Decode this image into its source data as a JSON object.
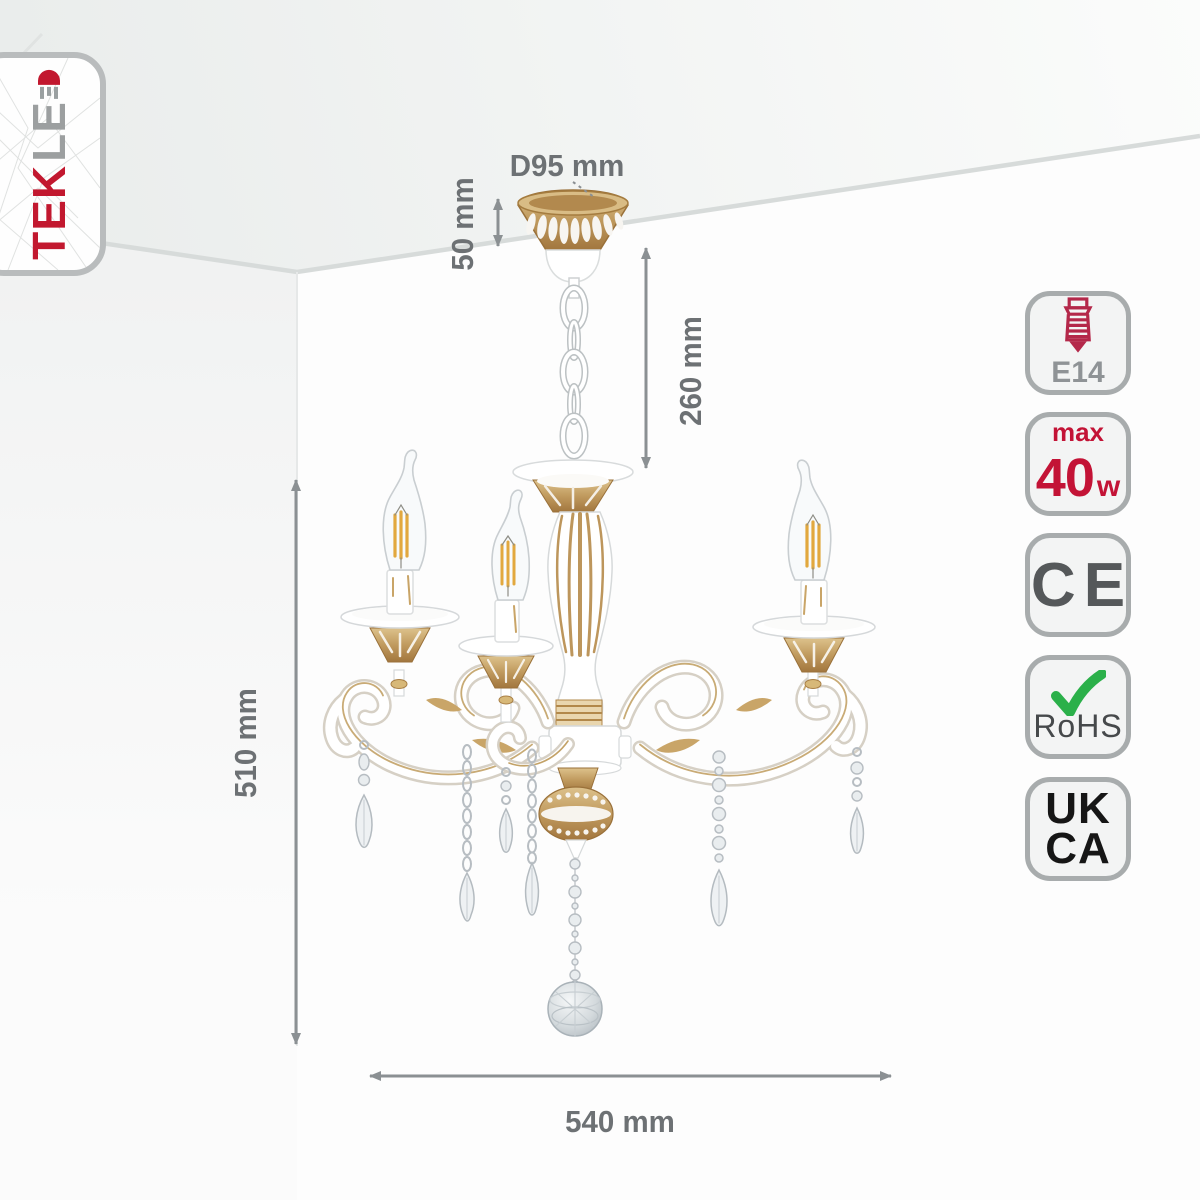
{
  "page": {
    "background": "#fdfdfd"
  },
  "brand": {
    "name_red": "TEK",
    "name_gray": "LE",
    "led_icon": "led-diode-icon"
  },
  "dimensions": {
    "canopy_diameter": "D95 mm",
    "canopy_height": "50 mm",
    "suspension_length": "260 mm",
    "fixture_height": "510 mm",
    "fixture_width": "540 mm"
  },
  "badges": {
    "socket": {
      "icon": "e14-bulb-icon",
      "label": "E14"
    },
    "power": {
      "prefix": "max",
      "value": "40",
      "unit": "w"
    },
    "ce": {
      "label": "CE"
    },
    "rohs": {
      "icon": "checkmark-icon",
      "label": "RoHS"
    },
    "ukca": {
      "line1": "UK",
      "line2": "CA"
    }
  },
  "colors": {
    "accent_red": "#c21335",
    "gold": "#b98e55",
    "dimension_gray": "#8b9093",
    "rohs_green": "#2bb04a",
    "certification_dark": "#55585a",
    "ukca_black": "#161616"
  }
}
